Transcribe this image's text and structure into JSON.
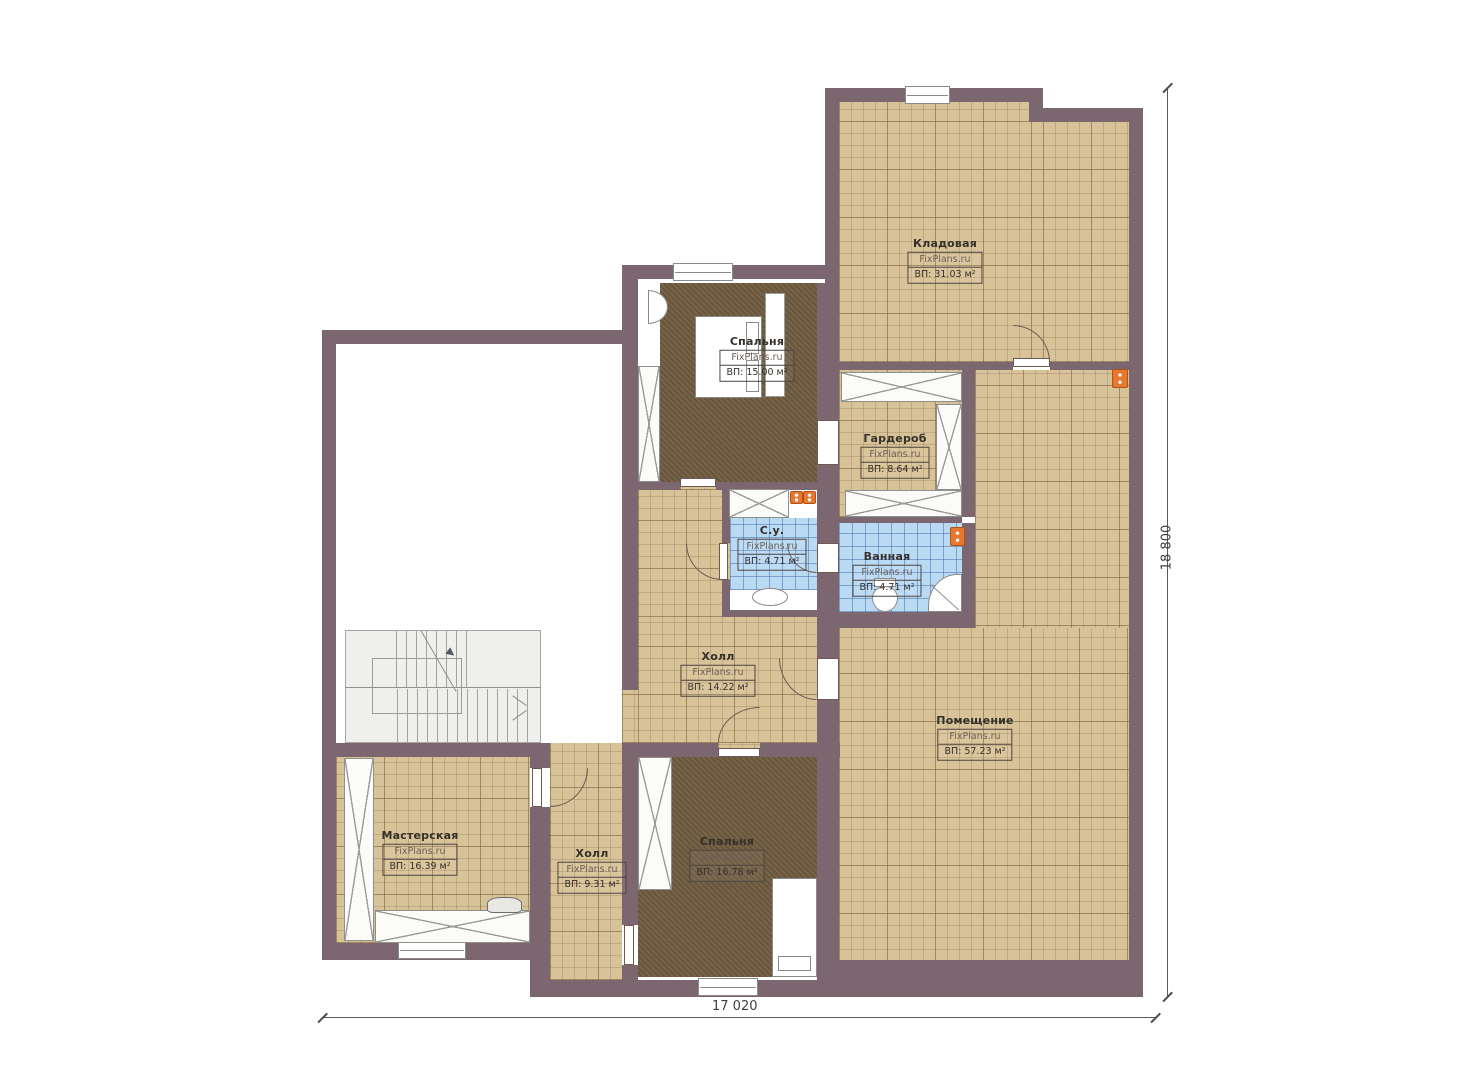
{
  "plan": {
    "title": "Floor plan",
    "watermark": "FixPlans.ru",
    "rooms": [
      {
        "id": "kladovaya",
        "name": "Кладовая",
        "area": "ВП: 31.03 м²"
      },
      {
        "id": "spalnya-top",
        "name": "Спальня",
        "area": "ВП: 15.00 м²"
      },
      {
        "id": "garderob",
        "name": "Гардероб",
        "area": "ВП: 8.64 м²"
      },
      {
        "id": "su",
        "name": "С.у.",
        "area": "ВП: 4.71 м²"
      },
      {
        "id": "vannaya",
        "name": "Ванная",
        "area": "ВП: 4.71 м²"
      },
      {
        "id": "holl-top",
        "name": "Холл",
        "area": "ВП: 14.22 м²"
      },
      {
        "id": "pomeshchenie",
        "name": "Помещение",
        "area": "ВП: 57.23 м²"
      },
      {
        "id": "masterskaya",
        "name": "Мастерская",
        "area": "ВП: 16.39 м²"
      },
      {
        "id": "holl-bottom",
        "name": "Холл",
        "area": "ВП: 9.31 м²"
      },
      {
        "id": "spalnya-bottom",
        "name": "Спальня",
        "area": "ВП: 16.78 м²"
      }
    ],
    "dimensions": {
      "width": "17 020",
      "height": "18 800"
    },
    "colors": {
      "wall": "#7c6770",
      "floor_tile": "#d8c298",
      "floor_carpet": "#6f5b3f",
      "floor_bath": "#badaf4",
      "radiator": "#e8782f"
    }
  }
}
